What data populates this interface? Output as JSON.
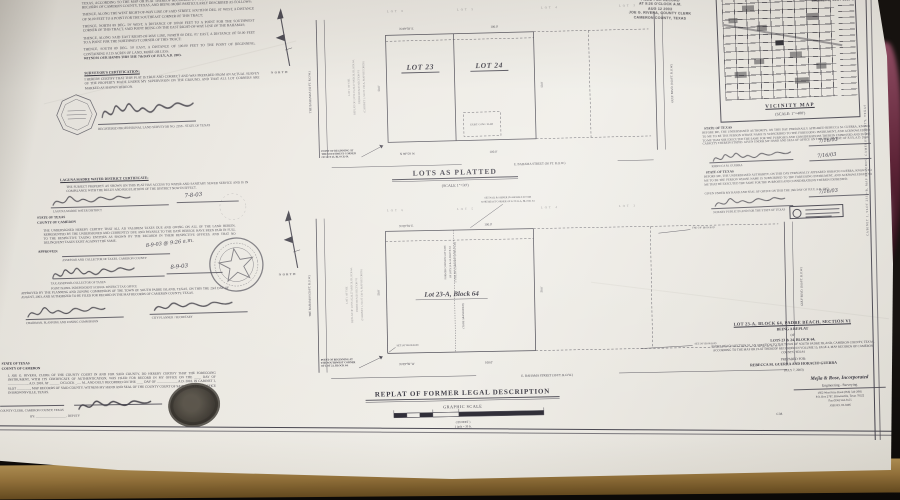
{
  "photo": {
    "background": "#16120f",
    "table_wood": "#91703a",
    "paper": "#eae7e0",
    "ink": "#34323c",
    "maroon_object": "#5c2336"
  },
  "sheet": {
    "side_note": "CABINET 1, SLOT 2319-B, MAP RECORDS, CAMERON COUNTY, TEXAS"
  },
  "stamps": {
    "recording_lines": [
      "FILED FOR RECORD",
      "AT 9:26 O'CLOCK A.M.",
      "AUG 12 2003",
      "JOE G. RIVERA, COUNTY CLERK",
      "CAMERON COUNTY, TEXAS"
    ],
    "corner_lines": [
      "DULY RECORDED",
      "CABINET 1, SLOT 2319-B"
    ]
  },
  "north": {
    "label": "NORTH"
  },
  "left": {
    "paras": [
      "BEING THE NORTHEASTERLY ONE-HALF (NE 1/2) OF LOT TWENTY-THREE (23), BLOCK SIXTY-FOUR (64), PADRE BEACH SECTION VI, AN ADDITION TO THE TOWN OF SOUTH PADRE ISLAND, CAMERON COUNTY, TEXAS, ACCORDING TO THE MAP OR PLAT THEREOF RECORDED IN VOLUME 15, PAGE 4, OF THE MAP RECORDS OF CAMERON COUNTY, TEXAS, AND BEING MORE PARTICULARLY DESCRIBED AS FOLLOWS:",
      "THENCE, ALONG THE WEST RIGHT-OF-WAY LINE OF SAID STREET, SOUTH 00 DEG. 01' WEST, A DISTANCE OF 50.00 FEET TO A POINT FOR THE SOUTHEAST CORNER OF THIS TRACT;",
      "THENCE, NORTH 89 DEG. 59' WEST, A DISTANCE OF 100.00 FEET TO A POINT FOR THE SOUTHWEST CORNER OF THIS TRACT, SAID POINT BEING ON THE EAST RIGHT-OF-WAY LINE OF THE BAHAMAS;",
      "THENCE, ALONG SAID EAST RIGHT-OF-WAY LINE, NORTH 00 DEG. 01' EAST, A DISTANCE OF 50.00 FEET TO A POINT FOR THE NORTHWEST CORNER OF THIS TRACT;",
      "THENCE, SOUTH 89 DEG. 59' EAST, A DISTANCE OF 100.00 FEET TO THE POINT OF BEGINNING, CONTAINING 0.115 ACRES OF LAND, MORE OR LESS."
    ],
    "witness": "WITNESS OUR HANDS THIS THE 7th DAY OF JULY, A.D. 2003.",
    "surv_header": "SURVEYOR'S CERTIFICATION:",
    "surv_text": "I HEREBY CERTIFY THAT THIS PLAT IS TRUE AND CORRECT AND WAS PREPARED FROM AN ACTUAL SURVEY OF THE PROPERTY MADE UNDER MY SUPERVISION ON THE GROUND, AND THAT ALL LOT CORNERS ARE MARKED AS SHOWN HEREON.",
    "surv_caption": "REGISTERED PROFESSIONAL LAND SURVEYOR NO. 2358 - STATE OF TEXAS"
  },
  "mid": {
    "water_header": "LAGUNA MADRE WATER DISTRICT CERTIFICATE:",
    "water_text": "THE SUBJECT PROPERTY AS SHOWN ON THIS PLAT HAS ACCESS TO WATER AND SANITARY SEWER SERVICE AND IS IN COMPLIANCE WITH THE RULES AND REGULATIONS OF THE DISTRICT NOW IN EFFECT.",
    "water_caption": "LAGUNA MADRE WATER DISTRICT",
    "water_date": "7-8-03",
    "state": "STATE OF TEXAS",
    "county": "COUNTY OF CAMERON",
    "tax_text": "THE UNDERSIGNED HEREBY CERTIFY THAT ALL AD VALOREM TAXES DUE AND OWING ON ALL OF THE LAND HEREIN, REPRESENTED BY THE UNDERSIGNED AND CURRENTLY DUE AND PAYABLE TO THE DATE HEREOF, HAVE BEEN PAID IN FULL TO THE RESPECTIVE TAXING ENTITIES AS SHOWN BY THE RECORDS IN THEIR RESPECTIVE OFFICES, AND THAT NO DELINQUENT TAXES EXIST AGAINST THE SAME.",
    "approved": "APPROVED:",
    "tax_caption": "ASSESSOR AND COLLECTOR OF TAXES, CAMERON COUNTY",
    "tax_note": "8-9-03 @ 9:26 a.m.",
    "tax_date": "8-9-03",
    "tax_cap1": "TAX ASSESSOR-COLLECTOR OF TAXES",
    "tax_cap2": "POINT ISABEL INDEPENDENT SCHOOL DISTRICT TAX OFFICE",
    "pz_text": "APPROVED BY THE PLANNING AND ZONING COMMISSION OF THE TOWN OF SOUTH PADRE ISLAND, TEXAS, ON THIS THE 23rd DAY OF AUGUST, 2003, AND AUTHORIZED TO BE FILED FOR RECORD IN THE MAP RECORDS OF CAMERON COUNTY, TEXAS.",
    "pz_cap1": "CHAIRMAN, PLANNING AND ZONING COMMISSION",
    "pz_cap2": "CITY PLANNER / SECRETARY"
  },
  "clerk": {
    "text": "I, JOE G. RIVERA, CLERK OF THE COUNTY COURT IN AND FOR SAID COUNTY, DO HEREBY CERTIFY THAT THE FOREGOING INSTRUMENT, WITH ITS CERTIFICATE OF AUTHENTICATION, WAS FILED FOR RECORD IN MY OFFICE ON THE ____ DAY OF ____________, A.D. 2003, AT ______ O'CLOCK ___. M., AND DULY RECORDED ON THE ____ DAY OF ____________, A.D. 2003, IN CABINET 1, SLOT ________, MAP RECORDS OF SAID COUNTY. WITNESS MY HAND AND SEAL OF THE COUNTY COURT OF SAID COUNTY, AT OFFICE IN BROWNSVILLE, TEXAS.",
    "cap1": "COUNTY CLERK, CAMERON COUNTY, TEXAS",
    "cap2": "BY: ____________________ , DEPUTY"
  },
  "ack": {
    "text1": "BEFORE ME, THE UNDERSIGNED AUTHORITY, ON THIS DAY PERSONALLY APPEARED REBECCA M. GUERRA, KNOWN TO ME TO BE THE PERSON WHOSE NAME IS SUBSCRIBED TO THE FOREGOING INSTRUMENT, AND ACKNOWLEDGED TO ME THAT SHE EXECUTED THE SAME FOR THE PURPOSES AND CONSIDERATIONS THEREIN EXPRESSED AND IN THE CAPACITY THEREIN STATED. GIVEN UNDER MY HAND AND SEAL OF OFFICE ON THIS THE 16th DAY OF JULY, A.D. 2003.",
    "owner1": "REBECCA M. GUERRA",
    "date1": "7/16/03",
    "date2": "7/16/03",
    "text2": "BEFORE ME, THE UNDERSIGNED AUTHORITY, ON THIS DAY PERSONALLY APPEARED HORACIO GUERRA, KNOWN TO ME TO BE THE PERSON WHOSE NAME IS SUBSCRIBED TO THE FOREGOING INSTRUMENT, AND ACKNOWLEDGED TO ME THAT HE EXECUTED THE SAME FOR THE PURPOSES AND CONSIDERATIONS THEREIN EXPRESSED.",
    "given": "GIVEN UNDER MY HAND AND SEAL OF OFFICE ON THIS THE 16th DAY OF JULY, A.D. 2003.",
    "notary_caption": "NOTARY PUBLIC IN AND FOR THE STATE OF TEXAS",
    "date3": "7/16/03"
  },
  "vicinity": {
    "title": "VICINITY MAP",
    "scale": "(SCALE: 1\"=400')"
  },
  "title_block": {
    "l1": "LOT 23-A, BLOCK 64, PADRE BEACH, SECTION VI",
    "l2": "BEING A REPLAT",
    "l3": "OF",
    "l4": "LOTS 23 & 24, BLOCK 64,",
    "l5": "PADRE BEACH SECTION VI, AN ADDITION TO THE TOWN OF SOUTH PADRE ISLAND, CAMERON COUNTY, TEXAS, ACCORDING TO THE MAP OR PLAT THEREOF RECORDED IN VOLUME 15, PAGE 4, MAP RECORDS OF CAMERON COUNTY, TEXAS",
    "l6": "PREPARED FOR:",
    "l7": "REBECCA M. GUERRA AND HORACIO GUERRA",
    "l8": "(JULY 7, 2003)"
  },
  "firm": {
    "f1": "Mejia & Rose, Incorporated",
    "f2": "Engineering - Surveying",
    "f3": "1662 West Price Road  (956) 544-2085",
    "f4": "P.O. Box 2787, Brownsville, Texas 78522",
    "f5": "Fax (956) 544-3555",
    "f6": "JOB NO. 03-0496",
    "cm": "C.M."
  },
  "plat_common": {
    "adjacent": [
      "LOT 6",
      "LOT 5",
      "LOT 4",
      "LOT 3"
    ],
    "dim_top_bearing": "N 89°59' E",
    "dim_top_len": "100.0'",
    "dim_bottom_bearing": "N 89°59' W",
    "dim_bottom_len": "100.0'",
    "dim_left": "50.0'",
    "dim_right": "50.0'",
    "left_road": "THE BAHAMAS  (50 FT. R.O.W.)",
    "right_road": "GULF BLVD.  (100 FT. R.O.W.)",
    "side_note": [
      "LOT 1 OF THE",
      "REPLAT OF LOTS 25,26,27 AND 28, BLOCK 64,",
      "PADRE BEACH SECTION VI",
      "(CABINET 1, SLOT 138-A, MAP RECORDS)"
    ],
    "street": "E. BAHAMA STREET  (30 FT. R.O.W.)",
    "pob": "POINT OF BEGINNING AT THE SOUTHWEST CORNER OF LOT 23, BLOCK 64."
  },
  "plat1": {
    "title": "LOTS AS PLATTED",
    "scale": "(SCALE 1\"=30')",
    "lot_left": "LOT 23",
    "lot_right": "LOT 24",
    "bldg_note": "EXIST. CONC. SLAB"
  },
  "plat2": {
    "title": "REPLAT OF FORMER LEGAL DESCRIPTION",
    "graphic_scale": "GRAPHIC SCALE",
    "in_feet": "( IN FEET )",
    "inch_eq": "1 inch = 30 ft.",
    "lot_label": "Lot 23-A, Block 64",
    "center_lines": [
      "FORMER COMMON LOT LINE",
      "OF LOTS 23 & 24, BLOCK 64",
      "5' UTILITY EASEMENT (THIS PLAT)"
    ],
    "abandon": "(TO BE ABANDONED)",
    "rod_ne": [
      "SET NAIL & SHINER IN ASPHALT AT THE",
      "NORTHEAST CORNER OF LOT 23-A, BLOCK 64"
    ],
    "rod_e": "FND 5/8\" IRON ROD",
    "rod_se": "SET 5/8\" IRON ROD",
    "rod_w": "SET 5/8\" IRON ROD"
  }
}
